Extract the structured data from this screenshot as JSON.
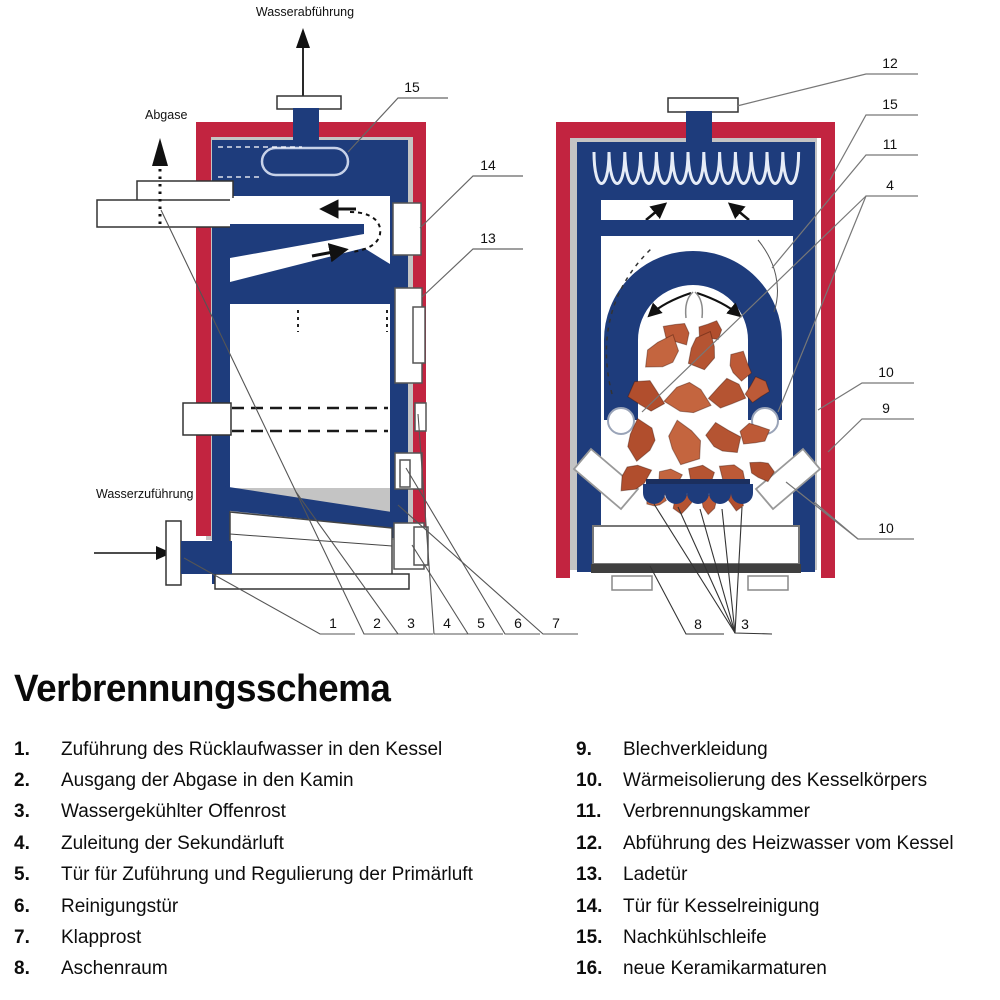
{
  "title": "Verbrennungsschema",
  "colors": {
    "red": "#c22440",
    "blue": "#1e3c7c",
    "insulation_gray": "#c4c4c4",
    "stone": "#bd5a37",
    "ink": "#111111"
  },
  "diagram": {
    "left": {
      "water_out_label": "Wasserabführung",
      "flue_label": "Abgase",
      "water_in_label": "Wasserzuführung",
      "callout_15": "15",
      "callout_14": "14",
      "callout_13": "13",
      "bottom_numbers": [
        "1",
        "2",
        "3",
        "4",
        "5",
        "6",
        "7"
      ]
    },
    "right": {
      "callouts": [
        "12",
        "15",
        "11",
        "4",
        "10",
        "9",
        "10"
      ],
      "bottom_numbers": [
        "8",
        "3"
      ]
    }
  },
  "legend": {
    "left": [
      {
        "num": "1.",
        "text": "Zuführung des Rücklaufwasser in den Kessel"
      },
      {
        "num": "2.",
        "text": "Ausgang der Abgase in den Kamin"
      },
      {
        "num": "3.",
        "text": "Wassergekühlter Offenrost"
      },
      {
        "num": "4.",
        "text": "Zuleitung der Sekundärluft"
      },
      {
        "num": "5.",
        "text": "Tür für Zuführung und Regulierung der Primärluft"
      },
      {
        "num": "6.",
        "text": "Reinigungstür"
      },
      {
        "num": "7.",
        "text": "Klapprost"
      },
      {
        "num": "8.",
        "text": "Aschenraum"
      }
    ],
    "right": [
      {
        "num": "9.",
        "text": "Blechverkleidung"
      },
      {
        "num": "10.",
        "text": "Wärmeisolierung des Kesselkörpers"
      },
      {
        "num": "11.",
        "text": "Verbrennungskammer"
      },
      {
        "num": "12.",
        "text": "Abführung des Heizwasser vom Kessel"
      },
      {
        "num": "13.",
        "text": "Ladetür"
      },
      {
        "num": "14.",
        "text": "Tür für Kesselreinigung"
      },
      {
        "num": "15.",
        "text": "Nachkühlschleife"
      },
      {
        "num": "16.",
        "text": "neue Keramikarmaturen"
      }
    ]
  }
}
